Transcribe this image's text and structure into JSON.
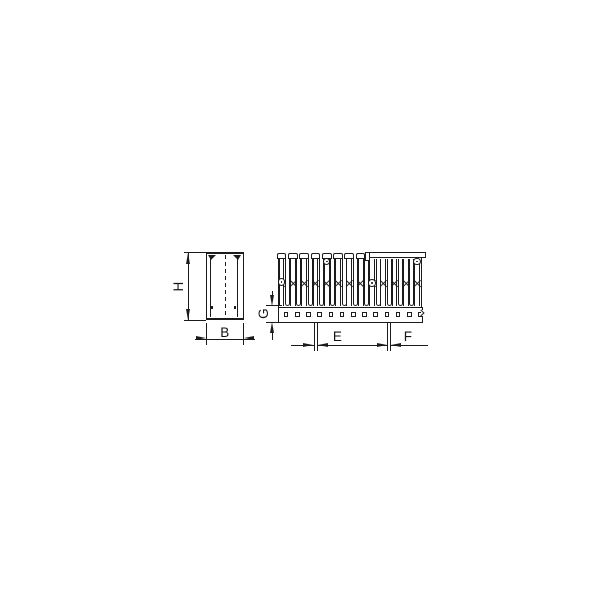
{
  "diagram": {
    "type": "technical-dimension-drawing",
    "subject": "slotted cable trunking duct, cross-section and side profile",
    "colors": {
      "line": "#1b1b1b",
      "background": "#ffffff"
    },
    "labels": {
      "height": "H",
      "width": "B",
      "base_height": "G",
      "slot_dim_open": "E",
      "slot_dim_cover": "F"
    },
    "front_view": {
      "name": "cross-section",
      "features": [
        "outer wall",
        "inner wall line",
        "corner lugs",
        "center line",
        "wall nubs"
      ]
    },
    "side_view": {
      "name": "slotted side profile",
      "finger_count": 13,
      "capped_finger_count": 8,
      "covered_finger_count": 5,
      "slot_count": 12,
      "screw_hole_count": 4,
      "base_hole_count": 13,
      "has_cover_section": true
    }
  }
}
